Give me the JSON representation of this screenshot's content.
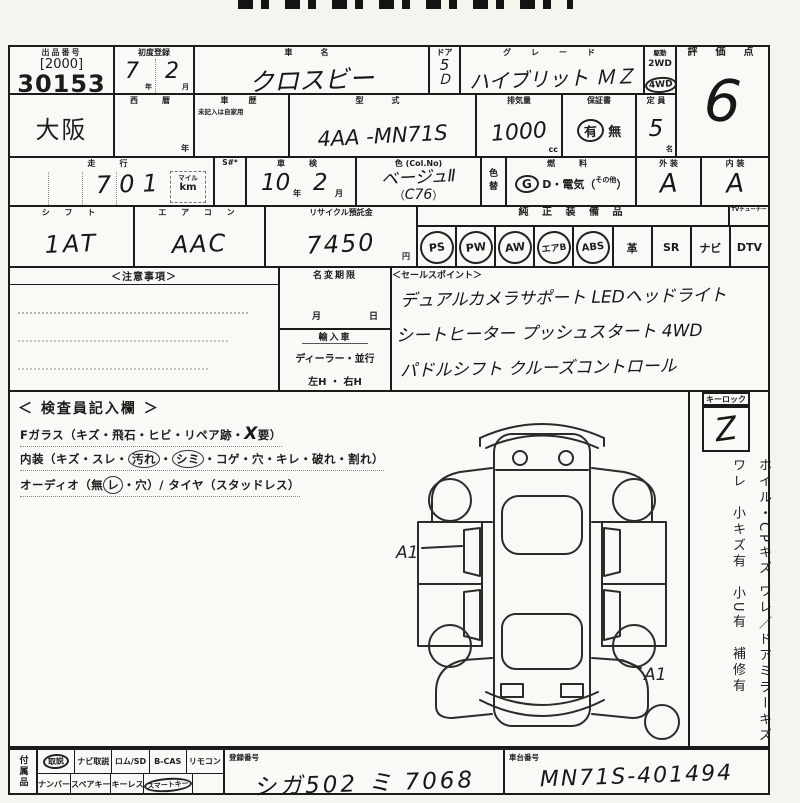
{
  "header": {
    "lot": {
      "label": "出品番号",
      "bracket": "[2000]",
      "number": "30153"
    },
    "first_reg": {
      "label": "初度登録",
      "year": "7",
      "month": "2",
      "year_unit": "年",
      "month_unit": "月"
    },
    "car_name": {
      "label": "車　名",
      "value": "クロスビー"
    },
    "door": {
      "label": "ドア",
      "value": "5",
      "suffix": "Ｄ"
    },
    "grade": {
      "label": "グ　レ　ー　ド",
      "value": "ハイブリット ＭＺ"
    },
    "drive": {
      "label": "駆動",
      "opt1": "2WD",
      "opt2": "4WD",
      "selected": "4WD"
    },
    "score": {
      "label": "評　価　点",
      "value": "6"
    },
    "auction_site": "大阪",
    "seireki": {
      "label": "西　暦",
      "unit": "年"
    },
    "history": {
      "label": "車　歴",
      "note": "未記入は自家用"
    },
    "model": {
      "label": "型　式",
      "value": "4AA -MN71S"
    },
    "displacement": {
      "label": "排気量",
      "value": "1000",
      "unit": "cc"
    },
    "warranty": {
      "label": "保証書",
      "yes": "有",
      "no": "無",
      "selected": "有"
    },
    "capacity": {
      "label": "定 員",
      "value": "5",
      "unit": "名"
    }
  },
  "row3": {
    "mileage": {
      "label": "走　行",
      "value": "701",
      "unit_top": "マイル",
      "unit_bottom": "km",
      "flag": "S#*"
    },
    "shaken": {
      "label": "車　検",
      "year": "10",
      "year_unit": "年",
      "month": "2",
      "month_unit": "月"
    },
    "color": {
      "label": "色 (Col.No)",
      "value": "ベージュⅡ",
      "open": "（",
      "code": "C76",
      "close": "）",
      "change_label_1": "色",
      "change_label_2": "替"
    },
    "fuel": {
      "label": "燃　料",
      "g": "G",
      "mid": "D・電気（",
      "other": "その他",
      "close": "）"
    },
    "exterior": {
      "label": "外 装",
      "value": "A"
    },
    "interior": {
      "label": "内 装",
      "value": "A"
    }
  },
  "row4": {
    "shift": {
      "label": "シ フ ト",
      "value": "1AT"
    },
    "aircon": {
      "label": "エ ア コ ン",
      "value": "AAC"
    },
    "recycle": {
      "label": "リサイクル預託金",
      "value": "7450",
      "unit": "円"
    },
    "equipment": {
      "label": "純 正 装 備 品",
      "tuner_note": "TVチューナー",
      "items": [
        {
          "name": "PS",
          "circled": true
        },
        {
          "name": "PW",
          "circled": true
        },
        {
          "name": "AW",
          "circled": true
        },
        {
          "name": "エアB",
          "circled": true
        },
        {
          "name": "ABS",
          "circled": true
        },
        {
          "name": "革",
          "circled": false
        },
        {
          "name": "SR",
          "circled": false
        },
        {
          "name": "ナビ",
          "circled": false
        },
        {
          "name": "DTV",
          "circled": false
        }
      ]
    }
  },
  "row5": {
    "notes_label": "＜注意事項＞",
    "name_change": {
      "label": "名変期限",
      "month": "月",
      "day": "日"
    },
    "import": {
      "label": "輸入車",
      "line1": "ディーラー・並行",
      "line2": "左H ・ 右H"
    },
    "sales": {
      "label": "＜セールスポイント＞",
      "line1": "デュアルカメラサポート LEDヘッドライト",
      "line2": "シートヒーター プッシュスタート 4WD",
      "line3": "パドルシフト クルーズコントロール"
    }
  },
  "inspector": {
    "label": "＜ 検査員記入欄 ＞",
    "line1_pre": "Fガラス（キズ・飛石・ヒビ・リペア跡・",
    "line1_mark": "X",
    "line1_post": "要）",
    "line2_pre": "内装（キズ・スレ・",
    "line2_c1": "汚れ",
    "line2_mid": "・",
    "line2_c2": "シミ",
    "line2_post": "・コゲ・穴・キレ・破れ・割れ）",
    "line3_pre": "オーディオ（無",
    "line3_c": "レ",
    "line3_post": "・穴）/ タイヤ（スタッドレス）",
    "mark_a1_left": "A1",
    "mark_a1_right": "A1"
  },
  "side": {
    "keylock": {
      "label": "キーロック",
      "mark": "Z"
    },
    "note": "ホイル・CPキズ ワレ／ドアミラーキズ ワレ　小キズ有　小U有　補修有"
  },
  "bottom": {
    "accessories_label": "付属品",
    "row1": [
      {
        "name": "取説",
        "circled": true
      },
      {
        "name": "ナビ取説",
        "circled": false
      },
      {
        "name": "ロム/SD",
        "circled": false
      },
      {
        "name": "B-CAS",
        "circled": false
      },
      {
        "name": "リモコン",
        "circled": false
      }
    ],
    "row2": [
      {
        "name": "ナンバー",
        "circled": false
      },
      {
        "name": "スペアキー",
        "circled": false
      },
      {
        "name": "キーレス",
        "circled": false
      },
      {
        "name": "スマートキー",
        "circled": true
      },
      {
        "name": "",
        "circled": false
      }
    ],
    "registration": {
      "label": "登録番号",
      "value": "シガ502 ミ 7068"
    },
    "chassis": {
      "label": "車台番号",
      "value": "MN71S-401494"
    }
  }
}
